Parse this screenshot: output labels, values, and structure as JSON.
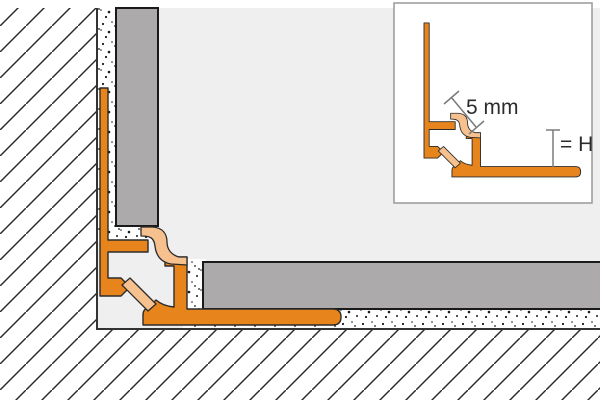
{
  "diagram": {
    "title": "Tile edge cove profile - inside corner cross-section",
    "inset": {
      "width_label": "5 mm",
      "height_label": "= H"
    },
    "colors": {
      "profile_orange": "#E8841C",
      "insert_peach": "#F6C18E",
      "tile_gray": "#ACAAAB",
      "surface_light": "#EFEFEF",
      "tile_edge_dark": "#1A1A1A",
      "outline_dark": "#2B2B2B",
      "substrate_boundary": "#333333",
      "hatch_line": "#2B2B2B",
      "speckle_dot": "#1A1A1A",
      "dimension_gray": "#7A7A7A",
      "dimension_text": "#2B2B2B",
      "inset_border": "#999999",
      "background": "#FFFFFF"
    }
  }
}
